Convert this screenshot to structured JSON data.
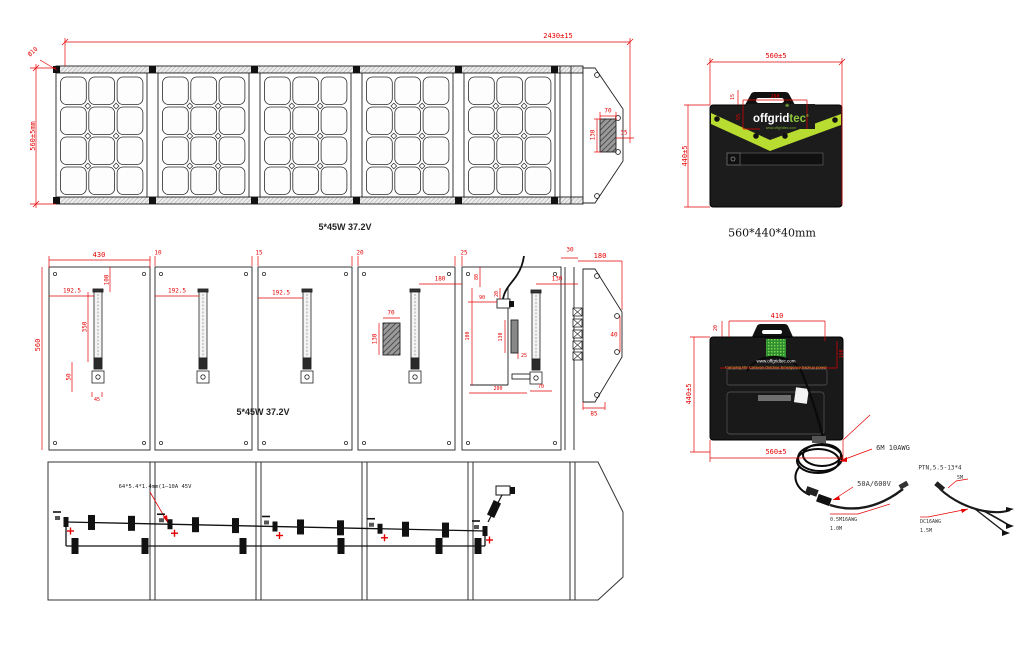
{
  "captions": {
    "front_view": "5*45W 37.2V",
    "back_view": "5*45W 37.2V",
    "case_size": "560*440*40mm"
  },
  "front": {
    "overall_width": "2430±15",
    "corner_hole": "Ø10",
    "height": "560±5mm",
    "pocket_width": "70",
    "pocket_height": "130",
    "pocket_offset": "35"
  },
  "back": {
    "panel_width": "430",
    "gaps": [
      "10",
      "15",
      "20",
      "25"
    ],
    "strip_width": "30",
    "leg_offsets": [
      "192.5",
      "192.5",
      "192.5"
    ],
    "leg_top": "100",
    "leg_length": "350",
    "leg_bottom": "50",
    "leg_foot": "45",
    "height": "560",
    "pocket_width": "70",
    "pocket_height": "130",
    "leg4_span": "180",
    "p5_top": "80",
    "p5_small": "20",
    "p5_box": "90",
    "p5_pocket_height": "130",
    "p5_pocket_gap": "25",
    "p5_inner": "100",
    "p5_bottom": "200",
    "p5_slot": "70",
    "p5_leg": "130",
    "flap_width": "180",
    "flap_tip": "40",
    "flap_bottom": "85"
  },
  "wiring": {
    "diode_label": "64*5.4*1.4mm(1—10A 45V"
  },
  "case_front": {
    "width": "560±5",
    "height": "440±5",
    "handle_inset": "15",
    "logo_width": "260",
    "logo_height": "55",
    "brand_white": "offgrid",
    "brand_green": "tec",
    "reg": "®",
    "flower": "❋",
    "tagline": "www.offgridtec.com"
  },
  "case_back": {
    "top_width": "410",
    "inset": "20",
    "height": "440±5",
    "width": "560±5",
    "side": "160",
    "url": "www.offgridtec.com",
    "tagline": "Camping RV Caravan Outdoor Emergency backup power",
    "cable_main": "6M 10AWG",
    "connector": "50A/600V",
    "ext1_spec": "0.5M16AWG",
    "ext1_len": "1.0M",
    "plug_spec": "PTN,5.5-13*4",
    "plug_len": "5M",
    "ext2_spec": "DC16AWG",
    "ext2_len": "1.5M"
  },
  "colors": {
    "dimension_red": "#e50000",
    "band_green": "#b9dc31",
    "logo_green": "#8dc63e",
    "tagline_orange": "#e8a33d",
    "case_black": "#1c1c1c"
  }
}
